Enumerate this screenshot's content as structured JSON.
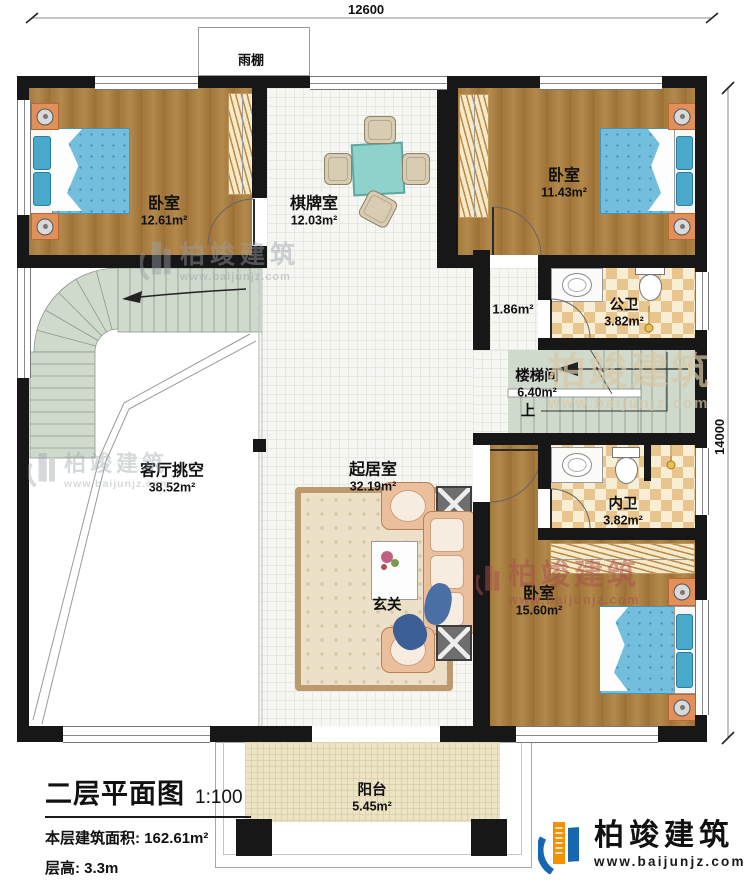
{
  "dimensions": {
    "top_width": "12600",
    "right_height": "14000"
  },
  "rooms": {
    "bedroom_top_left": {
      "name": "卧室",
      "area": "12.61m²"
    },
    "game_room": {
      "name": "棋牌室",
      "area": "12.03m²"
    },
    "bedroom_top_right": {
      "name": "卧室",
      "area": "11.43m²"
    },
    "hallway": {
      "area": "1.86m²"
    },
    "public_bathroom": {
      "name": "公卫",
      "area": "3.82m²"
    },
    "stairwell": {
      "name": "楼梯间",
      "area": "6.40m²",
      "up": "上"
    },
    "private_bathroom": {
      "name": "内卫",
      "area": "3.82m²"
    },
    "bedroom_bottom_right": {
      "name": "卧室",
      "area": "15.60m²"
    },
    "living_room": {
      "name": "起居室",
      "area": "32.19m²"
    },
    "living_void": {
      "name": "客厅挑空",
      "area": "38.52m²"
    },
    "foyer": {
      "name": "玄关"
    },
    "balcony": {
      "name": "阳台",
      "area": "5.45m²"
    },
    "canopy": {
      "name": "雨棚"
    }
  },
  "title_block": {
    "title": "二层平面图",
    "scale": "1:100",
    "floor_area": "本层建筑面积: 162.61m²",
    "floor_height": "层高: 3.3m"
  },
  "brand": {
    "name": "柏竣建筑",
    "url": "www.baijunjz.com"
  },
  "watermark": {
    "name": "柏竣建筑",
    "url": "www.baijunjz.com"
  },
  "colors": {
    "wall": "#171717",
    "wood_floor": "#a87c3f",
    "tile_floor": "#f6f6f2",
    "checker_tan": "#e9c48c",
    "stair_green": "#cfd9cc",
    "balcony_floor": "#ece4c5",
    "bed_blue": "#74bedd",
    "brand_blue": "#1667b0",
    "brand_orange": "#f29200",
    "watermark_gray": "#9ba1a8",
    "watermark_red": "#a84e4e"
  }
}
